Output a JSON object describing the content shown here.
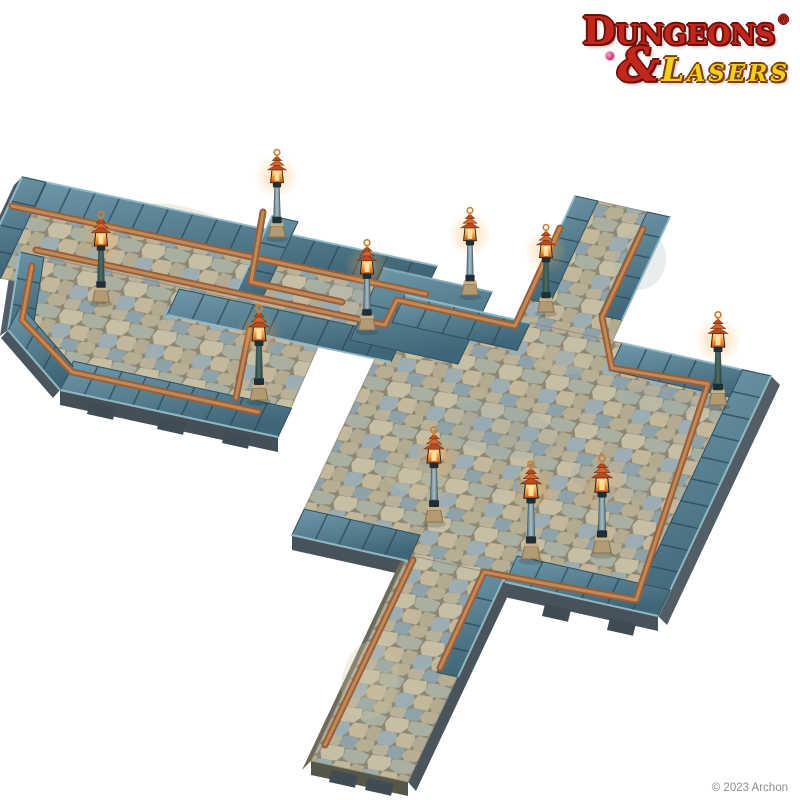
{
  "brand": {
    "line1": "Dungeons",
    "registered": "®",
    "ampersand": "&",
    "line2": "Lasers"
  },
  "footer": {
    "copyright": "© 2023 Archon"
  },
  "palette": {
    "background": "#ffffff",
    "logo_red": "#c1271c",
    "logo_red_outline": "#6e100a",
    "logo_yellow": "#f2cf1e",
    "logo_yellow_outline": "#7c3d08",
    "copyright_gray": "#8f8f8f",
    "cobble_grout": "#8c8673",
    "ground_edge": "#8d8776",
    "curb_light": "#6f9aab",
    "curb_dark": "#3f6678",
    "curb_line": "#2e4a57",
    "curb_highlight": "#9fc8d4",
    "curb_edge": "#33505c",
    "gutter_dark": "#9a5f3a",
    "gutter_light": "#c08a58",
    "lamp_base": "#b29a72",
    "lamp_collar": "#1f2d35",
    "pole_light": "#a9bec6",
    "pole_dark_green": "#4f6f66",
    "lantern_glow": "#ffd98e",
    "lantern_amber": "#f29a38",
    "lantern_deep": "#c05418",
    "cap_rust": "#bc4a1f",
    "finial_brass": "#c9823a",
    "tab_dark": "#3f4c55"
  },
  "scene": {
    "viewport": {
      "w": 800,
      "h": 800
    },
    "cobble": {
      "tile": [
        48,
        42
      ],
      "grout": "#8c8673",
      "transform": "matrix(0.976,0.216,-0.424,0.905,0,0)",
      "stones": [
        {
          "pts": [
            [
              3,
              2
            ],
            [
              20,
              1
            ],
            [
              22,
              8
            ],
            [
              18,
              14
            ],
            [
              5,
              15
            ],
            [
              1,
              8
            ]
          ],
          "fill": "#c6bfa5"
        },
        {
          "pts": [
            [
              24,
              2
            ],
            [
              36,
              1
            ],
            [
              46,
              3
            ],
            [
              45,
              11
            ],
            [
              33,
              13
            ],
            [
              25,
              10
            ]
          ],
          "fill": "#a9b0a1"
        },
        {
          "pts": [
            [
              2,
              18
            ],
            [
              14,
              17
            ],
            [
              17,
              24
            ],
            [
              13,
              30
            ],
            [
              3,
              30
            ],
            [
              0,
              24
            ]
          ],
          "fill": "#9cadb4"
        },
        {
          "pts": [
            [
              20,
              16
            ],
            [
              32,
              15
            ],
            [
              35,
              21
            ],
            [
              33,
              28
            ],
            [
              21,
              28
            ],
            [
              18,
              22
            ]
          ],
          "fill": "#c3b89c"
        },
        {
          "pts": [
            [
              38,
              15
            ],
            [
              47,
              16
            ],
            [
              47,
              27
            ],
            [
              39,
              28
            ],
            [
              35,
              22
            ]
          ],
          "fill": "#b2ab92"
        },
        {
          "pts": [
            [
              2,
              33
            ],
            [
              13,
              32
            ],
            [
              15,
              38
            ],
            [
              12,
              41
            ],
            [
              3,
              41
            ],
            [
              0,
              38
            ]
          ],
          "fill": "#bab19a"
        },
        {
          "pts": [
            [
              17,
              31
            ],
            [
              29,
              31
            ],
            [
              31,
              36
            ],
            [
              28,
              41
            ],
            [
              19,
              41
            ],
            [
              15,
              37
            ]
          ],
          "fill": "#8fa2a9"
        },
        {
          "pts": [
            [
              33,
              31
            ],
            [
              45,
              30
            ],
            [
              47,
              36
            ],
            [
              44,
              40
            ],
            [
              35,
              41
            ],
            [
              31,
              37
            ]
          ],
          "fill": "#b7ae94"
        }
      ]
    },
    "undersides": [
      {
        "pts": [
          [
            22,
            177
          ],
          [
            -23,
            273
          ],
          [
            -31,
            281
          ],
          [
            14,
            185
          ]
        ],
        "fill": "#4d5a63"
      },
      {
        "pts": [
          [
            60,
            390
          ],
          [
            278,
            437
          ],
          [
            278,
            452
          ],
          [
            60,
            405
          ]
        ],
        "fill": "#454f58"
      },
      {
        "pts": [
          [
            20,
            252
          ],
          [
            8,
            330
          ],
          [
            0,
            336
          ],
          [
            12,
            258
          ]
        ],
        "fill": "#525f68"
      },
      {
        "pts": [
          [
            8,
            330
          ],
          [
            60,
            390
          ],
          [
            53,
            398
          ],
          [
            1,
            338
          ]
        ],
        "fill": "#4a565f"
      },
      {
        "pts": [
          [
            292,
            535
          ],
          [
            658,
            616
          ],
          [
            658,
            631
          ],
          [
            292,
            550
          ]
        ],
        "fill": "#47525b"
      },
      {
        "pts": [
          [
            771,
            376
          ],
          [
            658,
            616
          ],
          [
            667,
            625
          ],
          [
            780,
            385
          ]
        ],
        "fill": "#515e67"
      },
      {
        "pts": [
          [
            408,
            555
          ],
          [
            311,
            761
          ],
          [
            302,
            770
          ],
          [
            399,
            564
          ]
        ],
        "fill": "#6e695a"
      },
      {
        "pts": [
          [
            311,
            761
          ],
          [
            408,
            782
          ],
          [
            408,
            796
          ],
          [
            311,
            775
          ]
        ],
        "fill": "#565649"
      },
      {
        "pts": [
          [
            505,
            576
          ],
          [
            408,
            782
          ],
          [
            416,
            791
          ],
          [
            513,
            585
          ]
        ],
        "fill": "#49545d"
      }
    ],
    "tabs": [
      [
        90,
        402
      ],
      [
        160,
        417
      ],
      [
        225,
        431
      ],
      [
        332,
        770
      ],
      [
        368,
        778
      ],
      [
        545,
        604
      ],
      [
        610,
        618
      ]
    ],
    "ground": [
      {
        "pts": [
          [
            22,
            177
          ],
          [
            437,
            266
          ],
          [
            392,
            362
          ],
          [
            -23,
            273
          ]
        ]
      },
      {
        "pts": [
          [
            20,
            252
          ],
          [
            330,
            320
          ],
          [
            278,
            437
          ],
          [
            60,
            390
          ],
          [
            8,
            330
          ]
        ]
      },
      {
        "pts": [
          [
            575,
            196
          ],
          [
            670,
            217
          ],
          [
            606,
            355
          ],
          [
            511,
            334
          ]
        ]
      },
      {
        "pts": [
          [
            405,
            295
          ],
          [
            771,
            376
          ],
          [
            658,
            616
          ],
          [
            292,
            535
          ]
        ]
      },
      {
        "pts": [
          [
            408,
            555
          ],
          [
            505,
            576
          ],
          [
            408,
            782
          ],
          [
            311,
            761
          ]
        ]
      }
    ],
    "patches": [
      {
        "cx": 500,
        "cy": 430,
        "rx": 60,
        "ry": 26,
        "fill": "#8da3ad",
        "op": 0.2
      },
      {
        "cx": 610,
        "cy": 480,
        "rx": 40,
        "ry": 18,
        "fill": "#8da3ad",
        "op": 0.22
      },
      {
        "cx": 420,
        "cy": 480,
        "rx": 34,
        "ry": 16,
        "fill": "#c9bfa0",
        "op": 0.3
      },
      {
        "cx": 660,
        "cy": 400,
        "rx": 36,
        "ry": 15,
        "fill": "#8da3ad",
        "op": 0.18
      },
      {
        "cx": 350,
        "cy": 300,
        "rx": 40,
        "ry": 16,
        "fill": "#8da3ad",
        "op": 0.2
      },
      {
        "cx": 180,
        "cy": 220,
        "rx": 45,
        "ry": 14,
        "fill": "#c9bfa0",
        "op": 0.28
      },
      {
        "cx": 560,
        "cy": 360,
        "rx": 30,
        "ry": 13,
        "fill": "#c9bfa0",
        "op": 0.25
      },
      {
        "cx": 370,
        "cy": 680,
        "rx": 28,
        "ry": 40,
        "fill": "#cfc4a4",
        "op": 0.28
      },
      {
        "cx": 640,
        "cy": 260,
        "rx": 26,
        "ry": 30,
        "fill": "#9aacb2",
        "op": 0.22
      }
    ],
    "curbs": [
      {
        "o": [
          [
            22,
            177
          ],
          [
            437,
            266
          ]
        ],
        "d": [
          -12.6,
          26.9
        ]
      },
      {
        "o": [
          [
            22,
            177
          ],
          [
            -23,
            273
          ]
        ],
        "d": [
          23.7,
          5.2
        ]
      },
      {
        "o": [
          [
            272,
            216
          ],
          [
            235,
            295
          ]
        ],
        "d": [
          26,
          5.7
        ]
      },
      {
        "o": [
          [
            167,
            315
          ],
          [
            391,
            362
          ]
        ],
        "d": [
          12.2,
          -25.9
        ]
      },
      {
        "pts": [
          [
            383,
            268
          ],
          [
            492,
            292
          ],
          [
            458,
            364
          ],
          [
            350,
            340
          ]
        ]
      },
      {
        "o": [
          [
            405,
            295
          ],
          [
            530,
            323
          ]
        ],
        "d": [
          -12.8,
          27.4
        ]
      },
      {
        "o": [
          [
            622,
            343
          ],
          [
            771,
            376
          ]
        ],
        "d": [
          -12.8,
          27.4
        ]
      },
      {
        "o": [
          [
            575,
            196
          ],
          [
            527,
            299
          ]
        ],
        "d": [
          22.8,
          5.0
        ]
      },
      {
        "o": [
          [
            670,
            217
          ],
          [
            622,
            320
          ]
        ],
        "d": [
          -22.8,
          -5.0
        ]
      },
      {
        "o": [
          [
            771,
            376
          ],
          [
            658,
            616
          ]
        ],
        "d": [
          -28.5,
          -6.3
        ]
      },
      {
        "o": [
          [
            505,
            582
          ],
          [
            658,
            616
          ]
        ],
        "d": [
          12.2,
          -25.9
        ]
      },
      {
        "o": [
          [
            292,
            535
          ],
          [
            408,
            561
          ]
        ],
        "d": [
          12.2,
          -25.9
        ]
      },
      {
        "o": [
          [
            505,
            576
          ],
          [
            458,
            677
          ]
        ],
        "d": [
          -20.9,
          -4.6
        ]
      },
      {
        "o": [
          [
            60,
            390
          ],
          [
            278,
            437
          ]
        ],
        "d": [
          13.5,
          -28.8
        ]
      },
      {
        "o": [
          [
            20,
            252
          ],
          [
            8,
            330
          ]
        ],
        "d": [
          24,
          5.3
        ]
      },
      {
        "o": [
          [
            8,
            330
          ],
          [
            60,
            390
          ]
        ],
        "d": [
          13,
          -24
        ]
      }
    ],
    "gutters": {
      "width_outer": 7,
      "width_inner": 3,
      "paths": [
        [
          [
            12,
            206
          ],
          [
            426,
            294
          ]
        ],
        [
          [
            36,
            250
          ],
          [
            385,
            325
          ],
          [
            397,
            300
          ],
          [
            515,
            326
          ],
          [
            560,
            228
          ]
        ],
        [
          [
            263,
            212
          ],
          [
            251,
            282
          ],
          [
            342,
            302
          ]
        ],
        [
          [
            643,
            229
          ],
          [
            602,
            317
          ],
          [
            612,
            368
          ],
          [
            708,
            384
          ],
          [
            636,
            600
          ],
          [
            526,
            580
          ],
          [
            484,
            572
          ],
          [
            440,
            668
          ]
        ],
        [
          [
            32,
            266
          ],
          [
            22,
            320
          ],
          [
            72,
            372
          ],
          [
            258,
            412
          ]
        ],
        [
          [
            250,
            328
          ],
          [
            236,
            398
          ]
        ],
        [
          [
            413,
            560
          ],
          [
            325,
            745
          ]
        ]
      ]
    },
    "lamps": [
      {
        "x": 277,
        "y": 237,
        "s": 0.92,
        "dark": false
      },
      {
        "x": 101,
        "y": 302,
        "s": 0.95,
        "dark": true
      },
      {
        "x": 367,
        "y": 330,
        "s": 0.95,
        "dark": false
      },
      {
        "x": 470,
        "y": 295,
        "s": 0.92,
        "dark": false
      },
      {
        "x": 546,
        "y": 312,
        "s": 0.92,
        "dark": true
      },
      {
        "x": 718,
        "y": 405,
        "s": 0.98,
        "dark": true
      },
      {
        "x": 259,
        "y": 400,
        "s": 1.0,
        "dark": true
      },
      {
        "x": 434,
        "y": 522,
        "s": 1.0,
        "dark": false
      },
      {
        "x": 531,
        "y": 559,
        "s": 1.03,
        "dark": false
      },
      {
        "x": 602,
        "y": 553,
        "s": 1.03,
        "dark": false
      }
    ]
  }
}
